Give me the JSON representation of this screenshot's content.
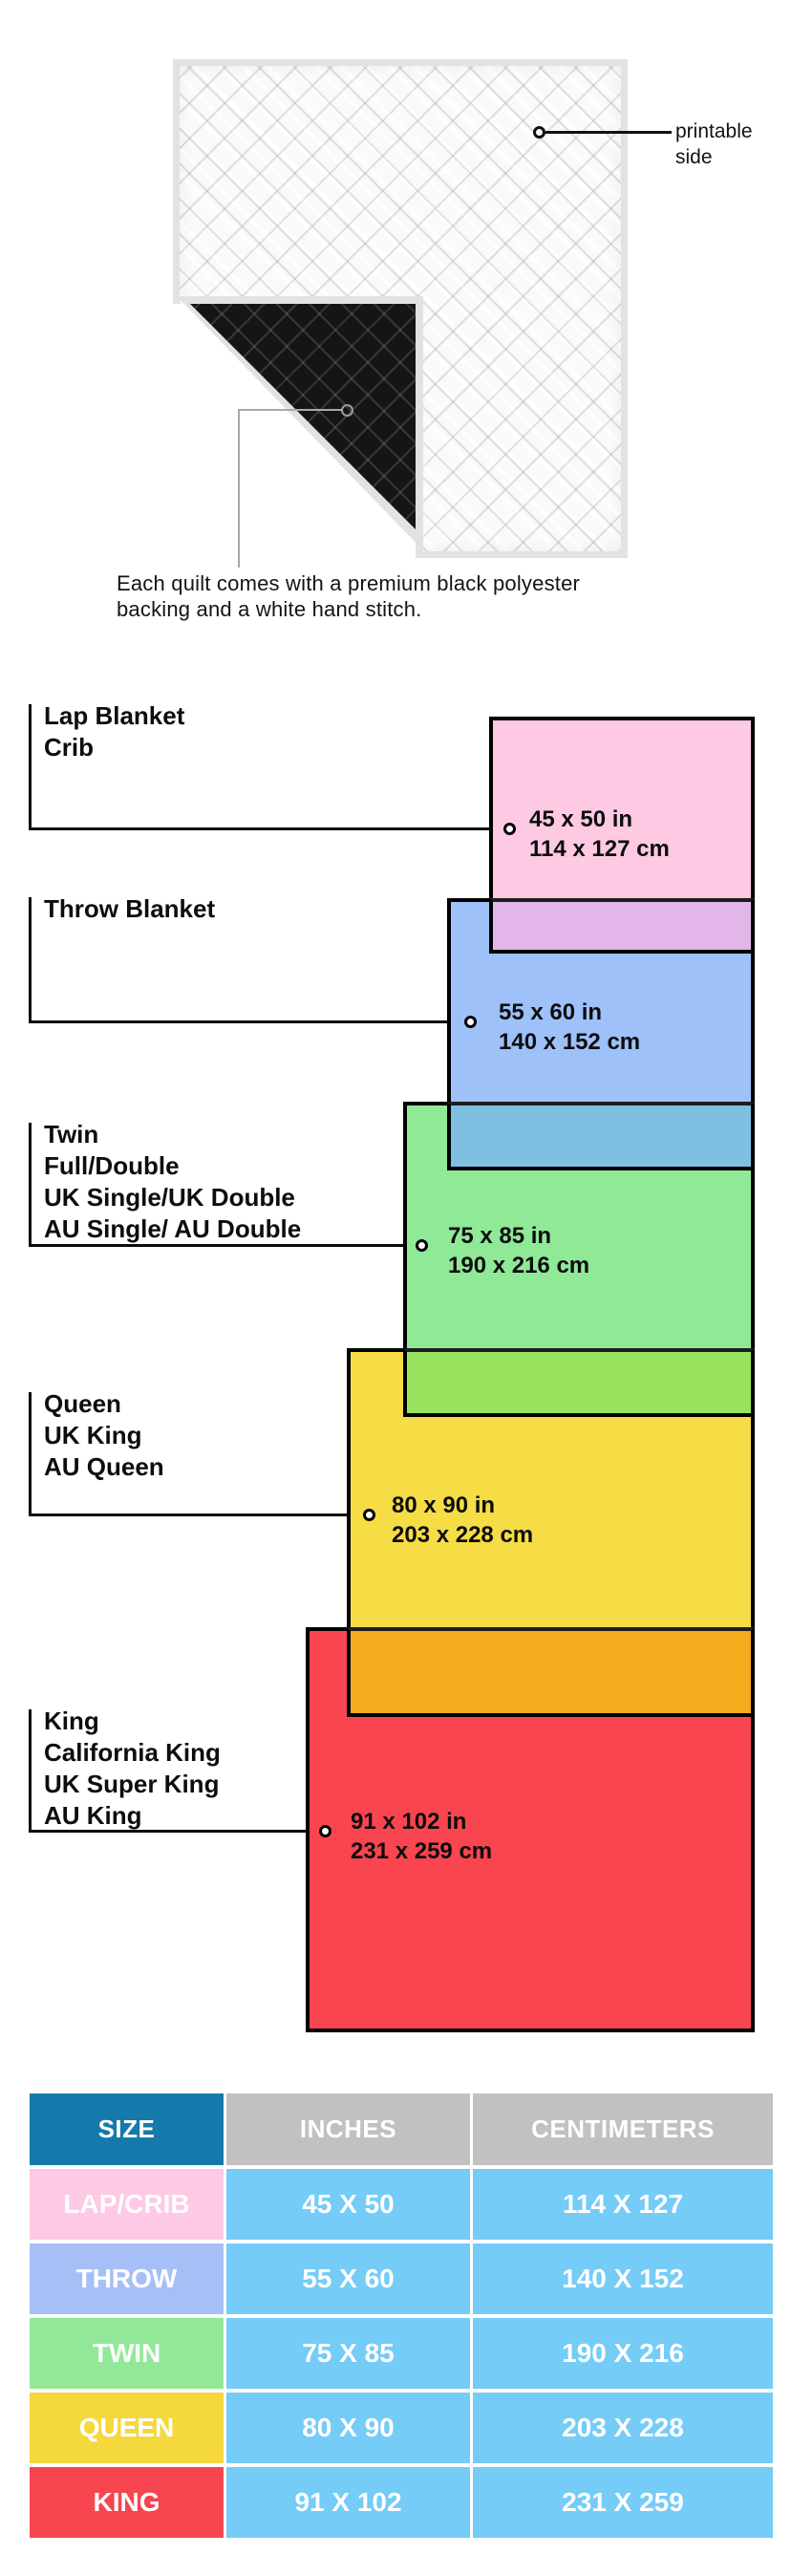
{
  "quilt": {
    "printable_label": "printable side",
    "caption_line1": "Each quilt comes with a premium black polyester",
    "caption_line2": "backing and a white hand stitch."
  },
  "diagram": {
    "groups": [
      {
        "labels": [
          "Lap Blanket",
          "Crib"
        ],
        "inches": "45 x 50 in",
        "cm": "114 x 127 cm",
        "color": "#fec9e3",
        "overlap_color": "#e2b6e8"
      },
      {
        "labels": [
          "Throw Blanket"
        ],
        "inches": "55 x 60 in",
        "cm": "140 x 152 cm",
        "color": "#9dc1f8",
        "overlap_color": "#7fbfe2"
      },
      {
        "labels": [
          "Twin",
          "Full/Double",
          "UK Single/UK Double",
          "AU Single/ AU Double"
        ],
        "inches": "75 x 85 in",
        "cm": "190 x 216 cm",
        "color": "#90e997",
        "overlap_color": "#98e35e"
      },
      {
        "labels": [
          "Queen",
          "UK King",
          "AU Queen"
        ],
        "inches": "80 x 90 in",
        "cm": "203 x 228 cm",
        "color": "#f6dc45",
        "overlap_color": "#f3ac1b"
      },
      {
        "labels": [
          "King",
          "California King",
          "UK Super King",
          "AU King"
        ],
        "inches": "91 x 102 in",
        "cm": "231 x 259 cm",
        "color": "#f9454f",
        "overlap_color": null
      }
    ]
  },
  "table": {
    "headers": [
      "SIZE",
      "INCHES",
      "CENTIMETERS"
    ],
    "header_size_bg": "#1579ab",
    "header_other_bg": "#c1c1c1",
    "value_bg": "#74ccf7",
    "rows": [
      {
        "size": "LAP/CRIB",
        "inches": "45 X 50",
        "cm": "114 X 127",
        "color": "#fec9e5"
      },
      {
        "size": "THROW",
        "inches": "55 X 60",
        "cm": "140 X 152",
        "color": "#a7bff7"
      },
      {
        "size": "TWIN",
        "inches": "75 X 85",
        "cm": "190 X 216",
        "color": "#92e898"
      },
      {
        "size": "QUEEN",
        "inches": "80 X 90",
        "cm": "203 X 228",
        "color": "#f5d73e"
      },
      {
        "size": "KING",
        "inches": "91 X 102",
        "cm": "231 X 259",
        "color": "#f6454f"
      }
    ]
  }
}
